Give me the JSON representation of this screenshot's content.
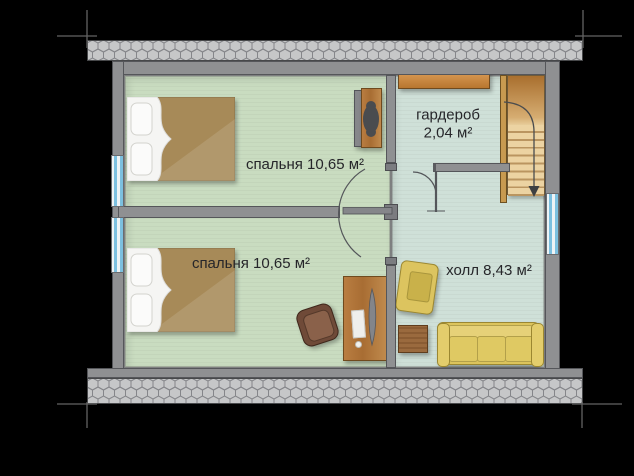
{
  "plan": {
    "type": "floor-plan",
    "rooms": [
      {
        "name": "bedroom-1",
        "label": "спальня 10,65 м²"
      },
      {
        "name": "bedroom-2",
        "label": "спальня 10,65 м²"
      },
      {
        "name": "wardrobe",
        "label": "гардероб",
        "area": "2,04 м²"
      },
      {
        "name": "hall",
        "label": "холл 8,43 м²"
      }
    ],
    "furniture": [
      "double-bed",
      "double-bed",
      "wardrobe-cabinet",
      "wall-shelf",
      "staircase-down",
      "desk",
      "desk-chair",
      "armchair",
      "coffee-table",
      "sofa"
    ],
    "colors": {
      "background": "#000000",
      "bedroom_floor": "#c9dcc0",
      "hall_floor": "#cfe0d8",
      "wall": "#8f9092",
      "roof_hatch": "#c6c7c8",
      "wood": "#b0763c",
      "stairs_wood": "#ecd3a2",
      "upholstery_yellow": "#dcc45c",
      "bed_blanket": "#a78a58",
      "window_glass": "#7cc0e0"
    }
  }
}
